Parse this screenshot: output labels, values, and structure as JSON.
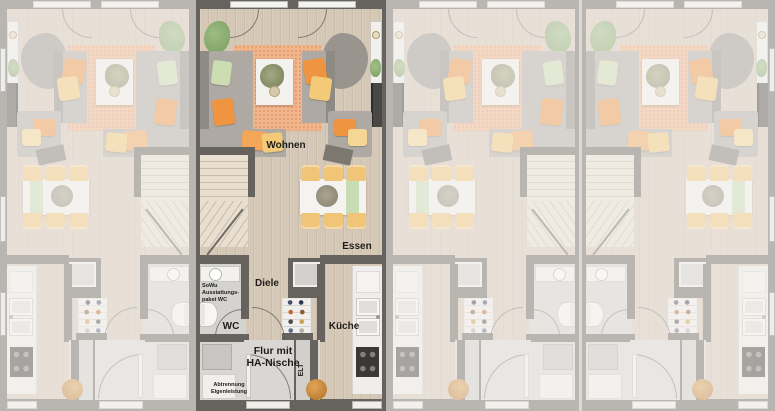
{
  "scene": {
    "units": [
      {
        "id": "unit-1",
        "mirrored": true,
        "highlighted": false
      },
      {
        "id": "unit-2",
        "mirrored": false,
        "highlighted": true
      },
      {
        "id": "unit-3",
        "mirrored": true,
        "highlighted": false
      },
      {
        "id": "unit-4",
        "mirrored": false,
        "highlighted": false
      }
    ]
  },
  "rooms": {
    "living": "Wohnen",
    "dining": "Essen",
    "hall": "Diele",
    "wc": "WC",
    "kitchen": "Küche",
    "entry": "Flur mit\nHA-Nische",
    "elt": "ELT"
  },
  "notes": {
    "wc_package": "SoWu\nAusstattungs-\npaket WC",
    "partition": "Abtrennung\nEigenleistung"
  },
  "colors": {
    "bg": "#8f8f8f",
    "wall": "#66625d",
    "floor_wood": "#d6c8b7",
    "floor_gray": "#d8d7d4",
    "rug": "#f1b58c",
    "rug_dot": "#e39c72",
    "stairs": "#e8dfd1",
    "stair_line": "#c9bca8",
    "sofa": "#aeaaa3",
    "sofa_dark": "#8e8a84",
    "cushion_orange": "#ef9440",
    "cushion_yellow": "#f3ca78",
    "cushion_green": "#cdddb2",
    "chair": "#f0c577",
    "runner": "#c9ddb5",
    "plant": "#82a568",
    "basket": "#b06f28",
    "text": "#1e1d1b",
    "dim": "rgba(244,242,238,0.58)"
  }
}
